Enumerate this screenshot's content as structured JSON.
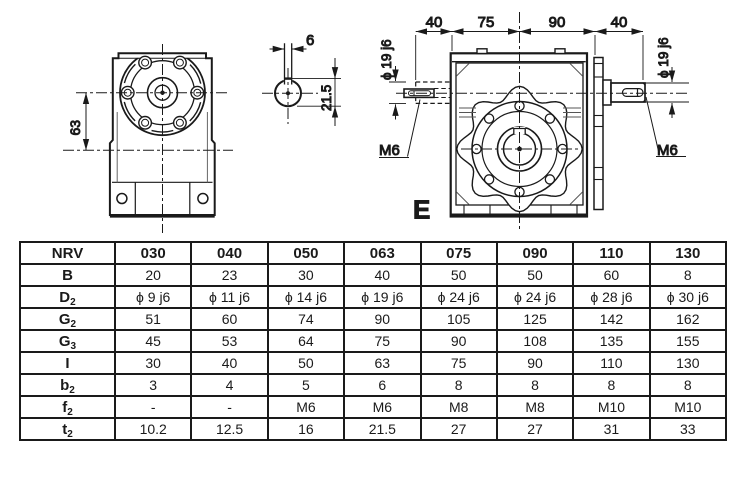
{
  "drawings": {
    "front_view": {
      "axis_distance": "63"
    },
    "shaft_section": {
      "keyway_width": "6",
      "hub_depth": "21.5"
    },
    "side_view": {
      "top_dims": [
        "40",
        "75",
        "90",
        "40"
      ],
      "shaft_dia_left": "ϕ 19 j6",
      "shaft_dia_right": "ϕ 19 j6",
      "tap_left": "M6",
      "tap_right": "M6",
      "view_label": "E"
    }
  },
  "table": {
    "header": [
      "NRV",
      "030",
      "040",
      "050",
      "063",
      "075",
      "090",
      "110",
      "130"
    ],
    "rows": [
      {
        "label": "B",
        "sub": "",
        "values": [
          "20",
          "23",
          "30",
          "40",
          "50",
          "50",
          "60",
          "8"
        ]
      },
      {
        "label": "D",
        "sub": "2",
        "values": [
          "ϕ 9 j6",
          "ϕ 11 j6",
          "ϕ 14 j6",
          "ϕ 19 j6",
          "ϕ 24 j6",
          "ϕ 24 j6",
          "ϕ 28 j6",
          "ϕ 30 j6"
        ]
      },
      {
        "label": "G",
        "sub": "2",
        "values": [
          "51",
          "60",
          "74",
          "90",
          "105",
          "125",
          "142",
          "162"
        ]
      },
      {
        "label": "G",
        "sub": "3",
        "values": [
          "45",
          "53",
          "64",
          "75",
          "90",
          "108",
          "135",
          "155"
        ]
      },
      {
        "label": "I",
        "sub": "",
        "values": [
          "30",
          "40",
          "50",
          "63",
          "75",
          "90",
          "110",
          "130"
        ]
      },
      {
        "label": "b",
        "sub": "2",
        "values": [
          "3",
          "4",
          "5",
          "6",
          "8",
          "8",
          "8",
          "8"
        ]
      },
      {
        "label": "f",
        "sub": "2",
        "values": [
          "-",
          "-",
          "M6",
          "M6",
          "M8",
          "M8",
          "M10",
          "M10"
        ]
      },
      {
        "label": "t",
        "sub": "2",
        "values": [
          "10.2",
          "12.5",
          "16",
          "21.5",
          "27",
          "27",
          "31",
          "33"
        ]
      }
    ]
  },
  "colors": {
    "ink": "#1a1a1a",
    "background": "#ffffff"
  }
}
